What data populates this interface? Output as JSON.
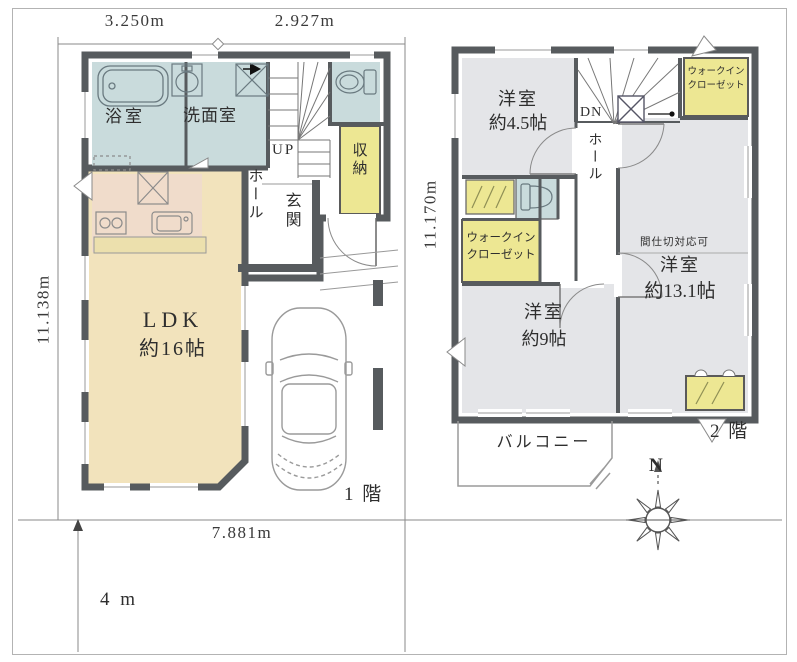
{
  "palette": {
    "wall": "#575b5e",
    "wet_room_blue": "#c9dbdc",
    "kitchen_pink": "#f0dccb",
    "ldk_cream": "#f2e3bc",
    "closet_yellow": "#ede793",
    "room_gray": "#e4e5e8",
    "line_gray": "#8a8a8a"
  },
  "dimensions": {
    "top_left": "3.250m",
    "top_right": "2.927m",
    "left_side": "11.138m",
    "center": "11.170m",
    "bottom": "7.881m",
    "road_width": "4 m"
  },
  "floor1": {
    "label": "1 階",
    "bath": "浴室",
    "washroom": "洗面室",
    "stairs": "UP",
    "hall": "ホール",
    "entrance": "玄関",
    "storage": "収納",
    "ldk": "LDK",
    "ldk_size": "約16帖"
  },
  "floor2": {
    "label": "2 階",
    "room_a": "洋室",
    "room_a_size": "約4.5帖",
    "stairs": "DN",
    "hall": "ホール",
    "wic_line1": "ウォークイン",
    "wic_line2": "クローゼット",
    "partition_note": "間仕切対応可",
    "room_b": "洋室",
    "room_b_size": "約13.1帖",
    "room_c": "洋室",
    "room_c_size": "約9帖",
    "balcony": "バルコニー"
  },
  "compass": {
    "north": "N"
  }
}
